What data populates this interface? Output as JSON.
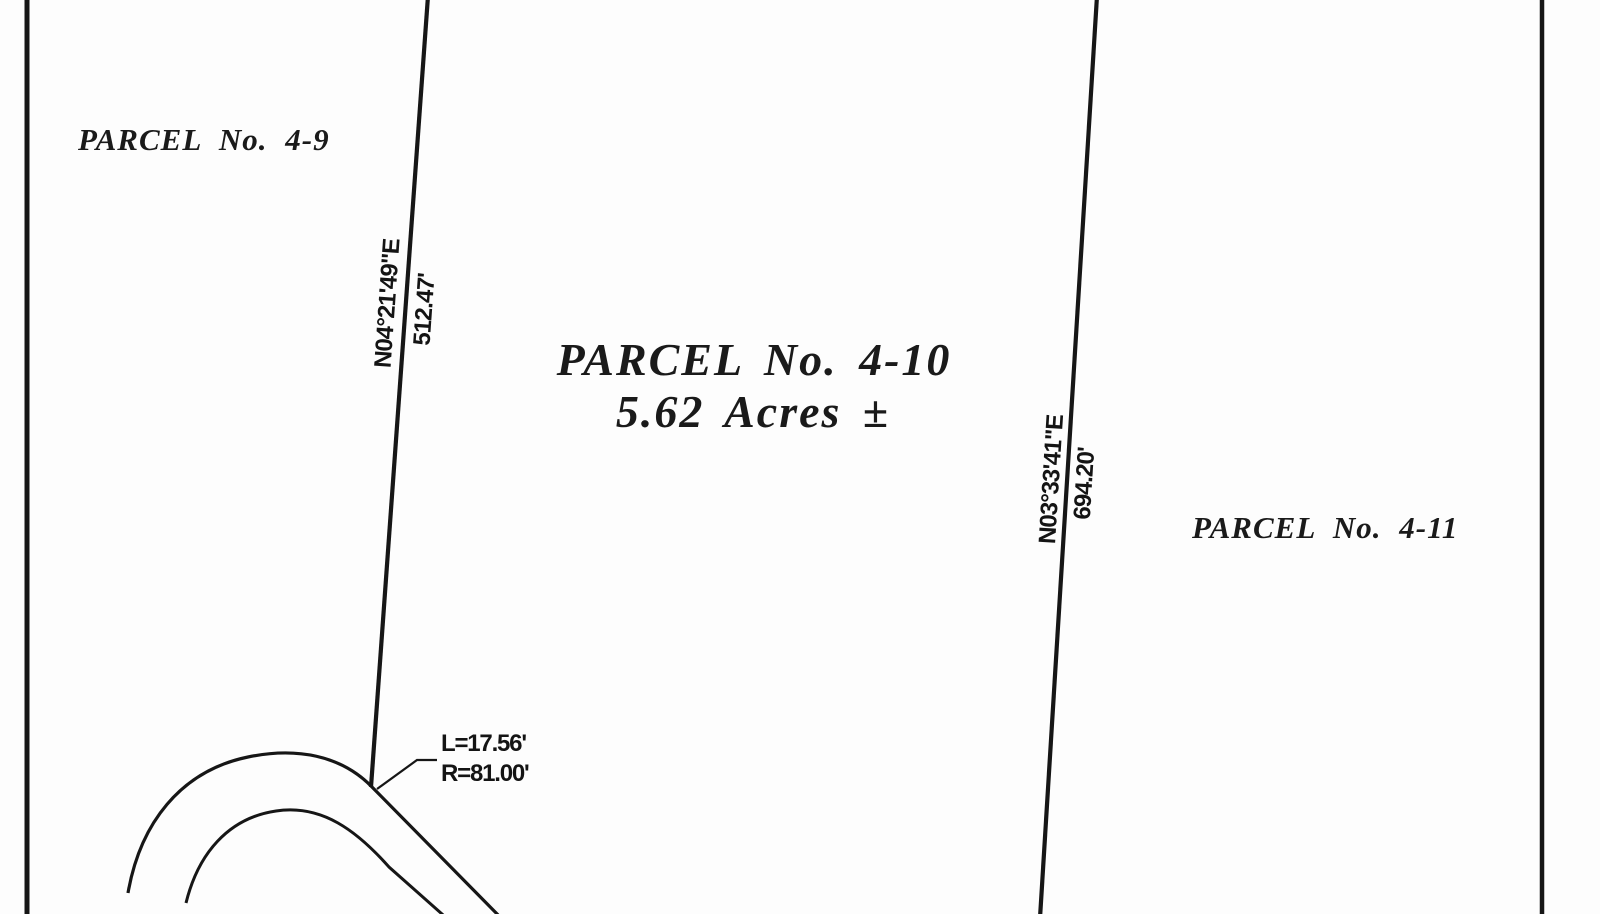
{
  "drawing_type": "survey-plat",
  "colors": {
    "ink": "#161616",
    "paper": "#fdfdfd"
  },
  "parcels": {
    "left": {
      "label": "PARCEL No. 4-9"
    },
    "center": {
      "label": "PARCEL No. 4-10",
      "area": "5.62 Acres ±"
    },
    "right": {
      "label": "PARCEL No. 4-11"
    }
  },
  "boundary_left": {
    "bearing": "N04°21'49\"E",
    "distance": "512.47'"
  },
  "boundary_right": {
    "bearing": "N03°33'41\"E",
    "distance": "694.20'"
  },
  "curve_callout": {
    "arc_length": "L=17.56'",
    "radius": "R=81.00'"
  }
}
